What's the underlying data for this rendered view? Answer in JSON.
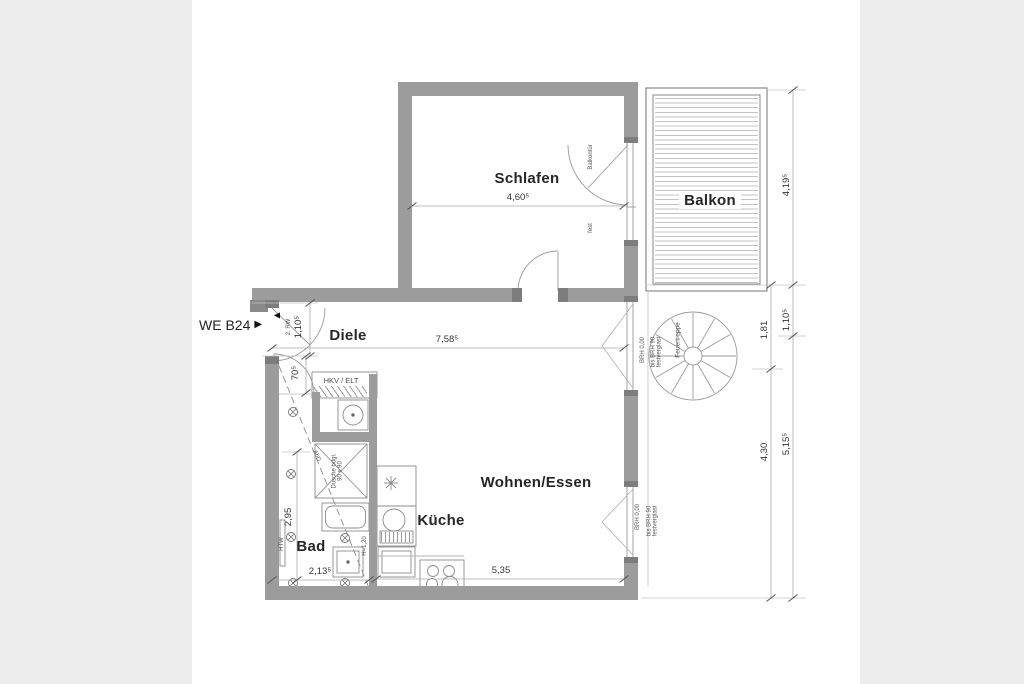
{
  "unit": {
    "label": "WE B24",
    "marker": "▶"
  },
  "rooms": {
    "schlafen": "Schlafen",
    "balkon": "Balkon",
    "diele": "Diele",
    "wohnen": "Wohnen/Essen",
    "kueche": "Küche",
    "bad": "Bad"
  },
  "dims": {
    "schlafen_width": "4,60⁵",
    "diele_width": "7,58⁵",
    "wohnen_width": "5,35",
    "bad_width": "2,13⁵",
    "bad_height": "2,95",
    "bad_door": "70⁵",
    "entry_width": "1,10⁵",
    "balkon_height": "4,19⁵",
    "stair_gap": "1,10⁵",
    "outer_lower": "5,15⁵",
    "inner_upper": "1,81",
    "inner_lower": "4,30"
  },
  "notes": {
    "rescue": "2. RW",
    "rescue_marker": "◀",
    "closet": "HKV / ELT",
    "balcony_door": "Balkontür",
    "fixed": "fest",
    "sill_zero": "BRH 0,00",
    "sill_note_1": "bis BRH 90",
    "sill_note_2": "festverglast",
    "stair": "Feuertreppe",
    "towel": "HTW",
    "half_wall": "H=1,20",
    "shower_1": "Dusche bdgl.",
    "shower_2": "90 x 90",
    "ceiling": "AbD"
  }
}
